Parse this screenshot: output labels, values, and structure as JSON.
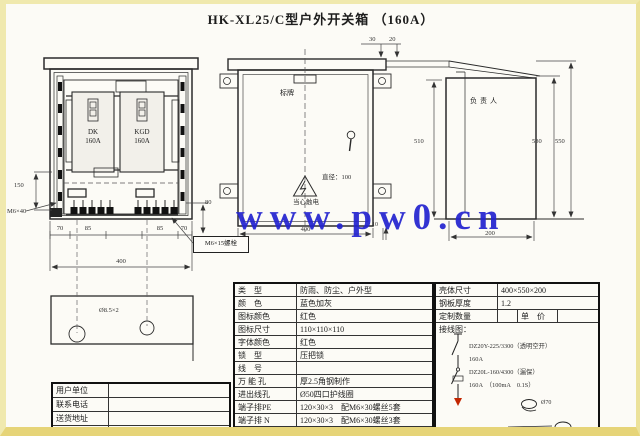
{
  "colors": {
    "watermark_blue": "#2323cf",
    "accent_red": "#c22500",
    "frame_yellow": "#efe6a8"
  },
  "title": "HK-XL25/C型户外开关箱 （160A）",
  "watermark": "www.pw0.cn",
  "front_view": {
    "breaker_left_name": "DK",
    "breaker_left_amp": "160A",
    "breaker_right_name": "KGD",
    "breaker_right_amp": "160A",
    "dim_70_left": "70",
    "dim_85_left": "85",
    "dim_85_right": "85",
    "dim_70_right": "70",
    "dim_width": "400",
    "dim_150": "150",
    "dim_80": "80",
    "bolt_left": "M6×40",
    "bolt_bottom": "M6×15螺栓"
  },
  "plate": {
    "hole_label": "Ø8.5×2"
  },
  "door_view": {
    "nameplate": "标牌",
    "warning": "当心触电",
    "diameter": "直径：100",
    "dim_width": "400",
    "dim_10": "10",
    "dim_30": "30",
    "dim_20": "20"
  },
  "side_view": {
    "owner": "负责人",
    "dim_510": "510",
    "dim_530": "530",
    "dim_550": "550",
    "dim_depth": "200"
  },
  "spec_table": {
    "rows": [
      {
        "label": "类　型",
        "value": "防雨、防尘、户外型"
      },
      {
        "label": "颜　色",
        "value": "蓝色加灰"
      },
      {
        "label": "图标颜色",
        "value": "红色"
      },
      {
        "label": "图标尺寸",
        "value": "110×110×110"
      },
      {
        "label": "字体颜色",
        "value": "红色"
      },
      {
        "label": "锁　型",
        "value": "压把锁"
      },
      {
        "label": "线　号",
        "value": ""
      },
      {
        "label": "万 能 孔",
        "value": "厚2.5角钢制作"
      },
      {
        "label": "进出线孔",
        "value": "Ø50四口护线圈"
      },
      {
        "label": "端子排PE",
        "value": "120×30×3　配M6×30螺丝5套"
      },
      {
        "label": "端子排 N",
        "value": "120×30×3　配M6×30螺丝3套"
      },
      {
        "label": "元件间距",
        "value": "≥　3㎜"
      }
    ]
  },
  "order_table": {
    "size_label": "壳体尺寸",
    "size_value": "400×550×200",
    "thickness_label": "钢板厚度",
    "thickness_value": "1.2",
    "qty_label": "定制数量",
    "qty_value": "",
    "price_label": "单　价",
    "price_value": "",
    "wiring_label": "接线图："
  },
  "wiring": {
    "breaker1_model": "DZ20Y-225/3300（透明空开）",
    "breaker1_amp": "160A",
    "breaker2_model": "DZ20L-160/4300（漏保）",
    "breaker2_amp": "160A　（100mA　0.1S）",
    "clamp_label": "Ø70"
  },
  "contact_table": {
    "rows": [
      {
        "label": "用户单位",
        "value": ""
      },
      {
        "label": "联系电话",
        "value": ""
      },
      {
        "label": "送货地址",
        "value": ""
      },
      {
        "label": "备　注",
        "value": ""
      }
    ]
  }
}
